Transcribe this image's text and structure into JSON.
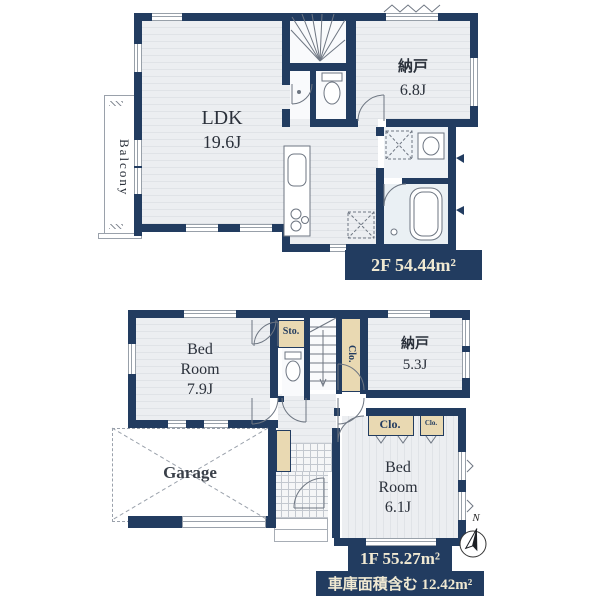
{
  "floor_2f": {
    "area_label": "2F 54.44m²",
    "ldk": {
      "name": "LDK",
      "size": "19.6J"
    },
    "nando": {
      "name": "納戸",
      "size": "6.8J"
    },
    "balcony": {
      "name": "Balcony"
    }
  },
  "floor_1f": {
    "area_label": "1F 55.27m²",
    "garage_area_label": "車庫面積含む 12.42m²",
    "bedroom_1": {
      "name": "Bed Room",
      "size": "7.9J"
    },
    "nando": {
      "name": "納戸",
      "size": "5.3J"
    },
    "bedroom_2": {
      "name": "Bed Room",
      "size": "6.1J"
    },
    "garage": {
      "name": "Garage"
    },
    "storage": {
      "name": "Sto."
    },
    "closet_tall": {
      "name": "Clo."
    },
    "closet_wide": {
      "name": "Clo."
    },
    "closet_small": {
      "name": "Clo."
    }
  },
  "compass": {
    "north_label": "N"
  }
}
